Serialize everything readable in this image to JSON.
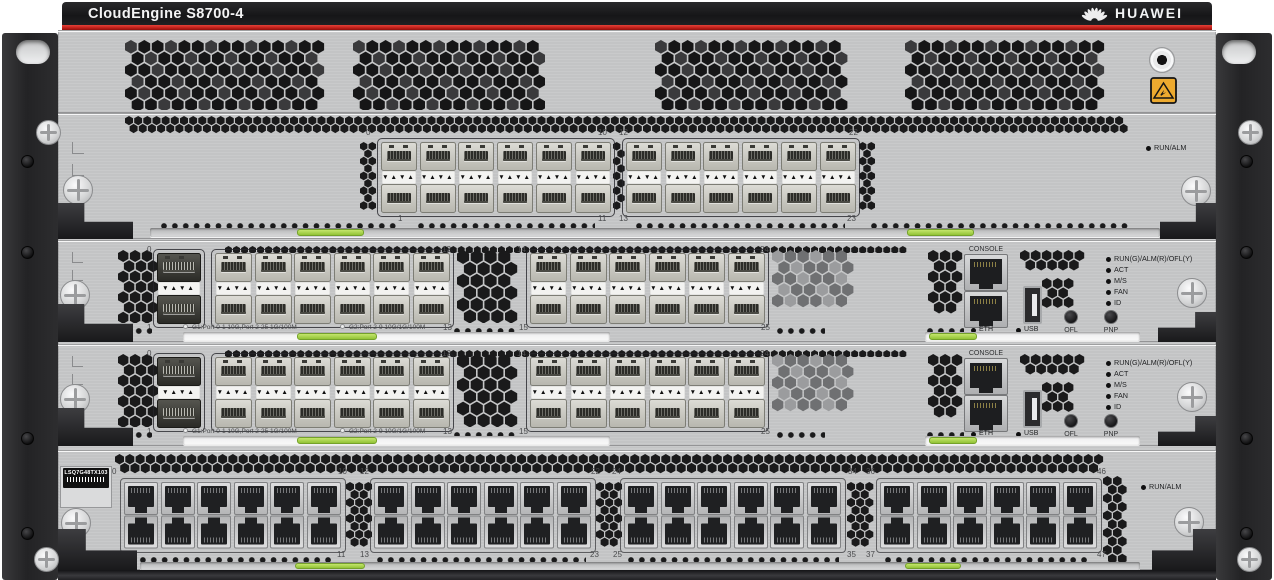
{
  "banner": {
    "model": "CloudEngine S8700-4",
    "brand": "HUAWEI"
  },
  "colors": {
    "brand_red": "#c2211b",
    "chassis_gray": "#d4d5d6",
    "indicator_green": "#a2d14f",
    "esd_yellow": "#edaa2f",
    "vent_black": "#1b1b1b"
  },
  "decor": {
    "tab_glyphs": "▼▲▼▲",
    "logo_icon": "huawei-flower-icon",
    "esd_icon": "esd-warning-icon"
  },
  "card1": {
    "top_numbers": [
      "0",
      "10",
      "12",
      "22"
    ],
    "bottom_numbers": [
      "1",
      "11",
      "13",
      "23"
    ],
    "run_alm_label": "RUN/ALM"
  },
  "sfp_card": {
    "top_numbers": [
      "0",
      "12",
      "14",
      "24"
    ],
    "bottom_numbers": [
      "1",
      "13",
      "15",
      "25"
    ],
    "console_label": "CONSOLE",
    "eth_label": "ETH",
    "usb_label": "USB",
    "ofl_label": "OFL",
    "pnp_label": "PNP",
    "led_labels": [
      "RUN(G)/ALM(R)/OFL(Y)",
      "ACT",
      "M/S",
      "FAN",
      "ID"
    ],
    "g1_label": "G1:Port 0-1 10G,Port 2-25 1G/100M",
    "g2_label": "G2:Port 2-9 10G/1G/100M"
  },
  "card4": {
    "module_label": "LSQ7G48TX103",
    "top_numbers": [
      "0",
      "10",
      "12",
      "22",
      "24",
      "34",
      "36",
      "46"
    ],
    "bottom_numbers": [
      "1",
      "11",
      "13",
      "23",
      "25",
      "35",
      "37",
      "47"
    ],
    "run_alm_label": "RUN/ALM"
  }
}
